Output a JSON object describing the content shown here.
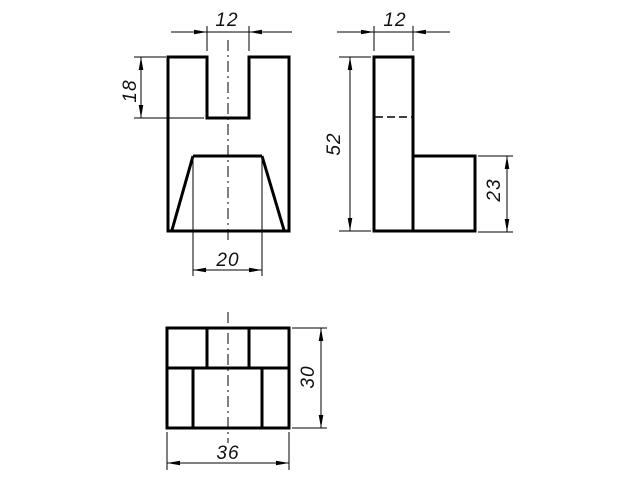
{
  "drawing": {
    "background_color": "#ffffff",
    "line_color": "#000000",
    "text_color": "#111111",
    "views": {
      "front": {
        "name": "front-view",
        "dims": {
          "slot_width": "12",
          "slot_depth": "18",
          "taper_top_width": "20"
        }
      },
      "side": {
        "name": "side-view",
        "dims": {
          "width": "12",
          "height": "52",
          "step_height": "23"
        }
      },
      "top": {
        "name": "top-view",
        "dims": {
          "width": "36",
          "depth": "30"
        }
      }
    }
  }
}
